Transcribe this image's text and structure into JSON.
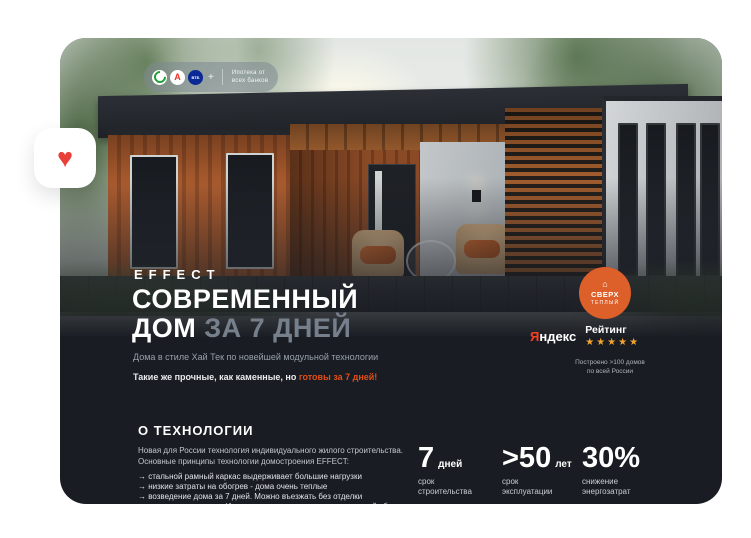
{
  "colors": {
    "card_bg": "#191c22",
    "accent_orange": "#e04e17",
    "badge_orange": "#dd5f2a",
    "star_orange": "#f0a32e",
    "heart_red": "#e84039",
    "yandex_red": "#fc3f1d",
    "title_dim": "#76808c"
  },
  "favorite": {
    "heart_glyph": "♥"
  },
  "mortgage_badge": {
    "plus": "+",
    "line1": "Ипотека от",
    "line2": "всех банков",
    "icons": [
      {
        "name": "sber-bank-icon"
      },
      {
        "name": "alfa-bank-icon",
        "glyph": "А"
      },
      {
        "name": "vtb-bank-icon",
        "glyph": "ВТБ"
      }
    ]
  },
  "warm_badge": {
    "icon_glyph": "⌂",
    "line1": "СВЕРХ",
    "line2": "ТЕПЛЫЙ"
  },
  "brand": {
    "logo": "EFFECT"
  },
  "hero": {
    "title_line1": "СОВРЕМЕННЫЙ",
    "title_line2_white": "ДОМ ",
    "title_line2_dim": "ЗА 7 ДНЕЙ",
    "subtitle": "Дома в стиле Хай Тек по новейшей модульной технологии",
    "tagline_plain": "Такие же прочные, как каменные, но ",
    "tagline_accent": "готовы за 7 дней!"
  },
  "rating": {
    "yandex_red": "Я",
    "yandex_rest": "ндекс",
    "label": "Рейтинг",
    "stars": "★★★★★",
    "note_line1": "Построено >100 домов",
    "note_line2": "по всей России"
  },
  "technology": {
    "heading": "О ТЕХНОЛОГИИ",
    "intro_line1": "Новая для России технология индивидуального жилого строительства.",
    "intro_line2": "Основные принципы технологии домостроения EFFECT:",
    "bullets": [
      "→ стальной рамный каркас выдерживает большие нагрузки",
      "→ низкие затраты на обогрев - дома очень теплые",
      "→ возведение дома за 7 дней. Можно въезжать без отделки",
      "→ заводское качество. Исключена вероятность некачественной сборки"
    ]
  },
  "stats": [
    {
      "value": "7",
      "unit": "дней",
      "caption_line1": "срок",
      "caption_line2": "строительства"
    },
    {
      "value": ">50",
      "unit": "лет",
      "caption_line1": "срок",
      "caption_line2": "эксплуатации"
    },
    {
      "value": "30%",
      "unit": "",
      "caption_line1": "снижение",
      "caption_line2": "энергозатрат"
    }
  ]
}
